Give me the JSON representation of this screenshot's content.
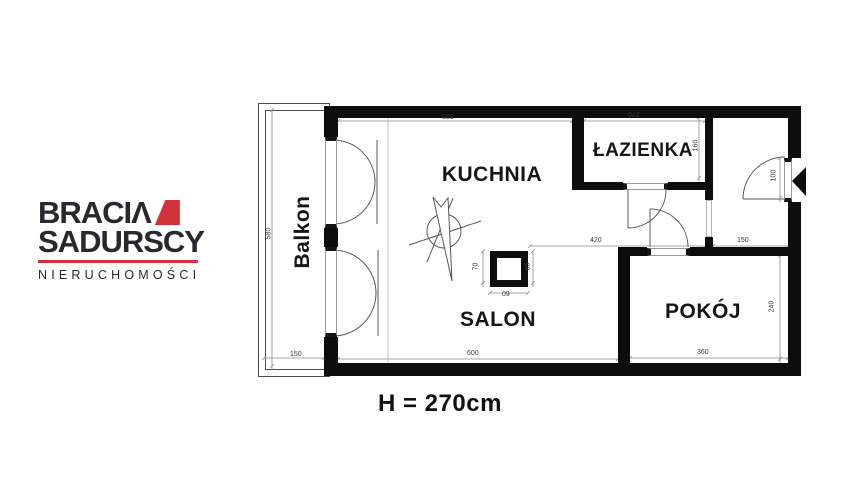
{
  "logo": {
    "brand_line1": "BRACIΛ",
    "brand_line2": "SADURSCY",
    "tagline": "NIERUCHOMOŚCI",
    "accent_color": "#cf3339",
    "ink_color": "#2a272e"
  },
  "plan": {
    "ceiling_height_note": "H = 270cm",
    "rooms": {
      "kuchnia": "KUCHNIA",
      "salon": "SALON",
      "lazienka": "ŁAZIENKA",
      "pokoj": "POKÓJ",
      "balkon": "Balkon"
    },
    "dims": {
      "kuchnia_width": "525",
      "lazienka_width": "270",
      "balkon_length": "580",
      "balkon_width": "150",
      "lazienka_depth": "160",
      "entry_opening": "100",
      "hall_length": "420",
      "entry_width": "150",
      "salon_width": "600",
      "pokoj_width": "360",
      "pokoj_depth": "240",
      "shaft_left": "70",
      "shaft_bottom": "60",
      "shaft_right": "65"
    }
  }
}
